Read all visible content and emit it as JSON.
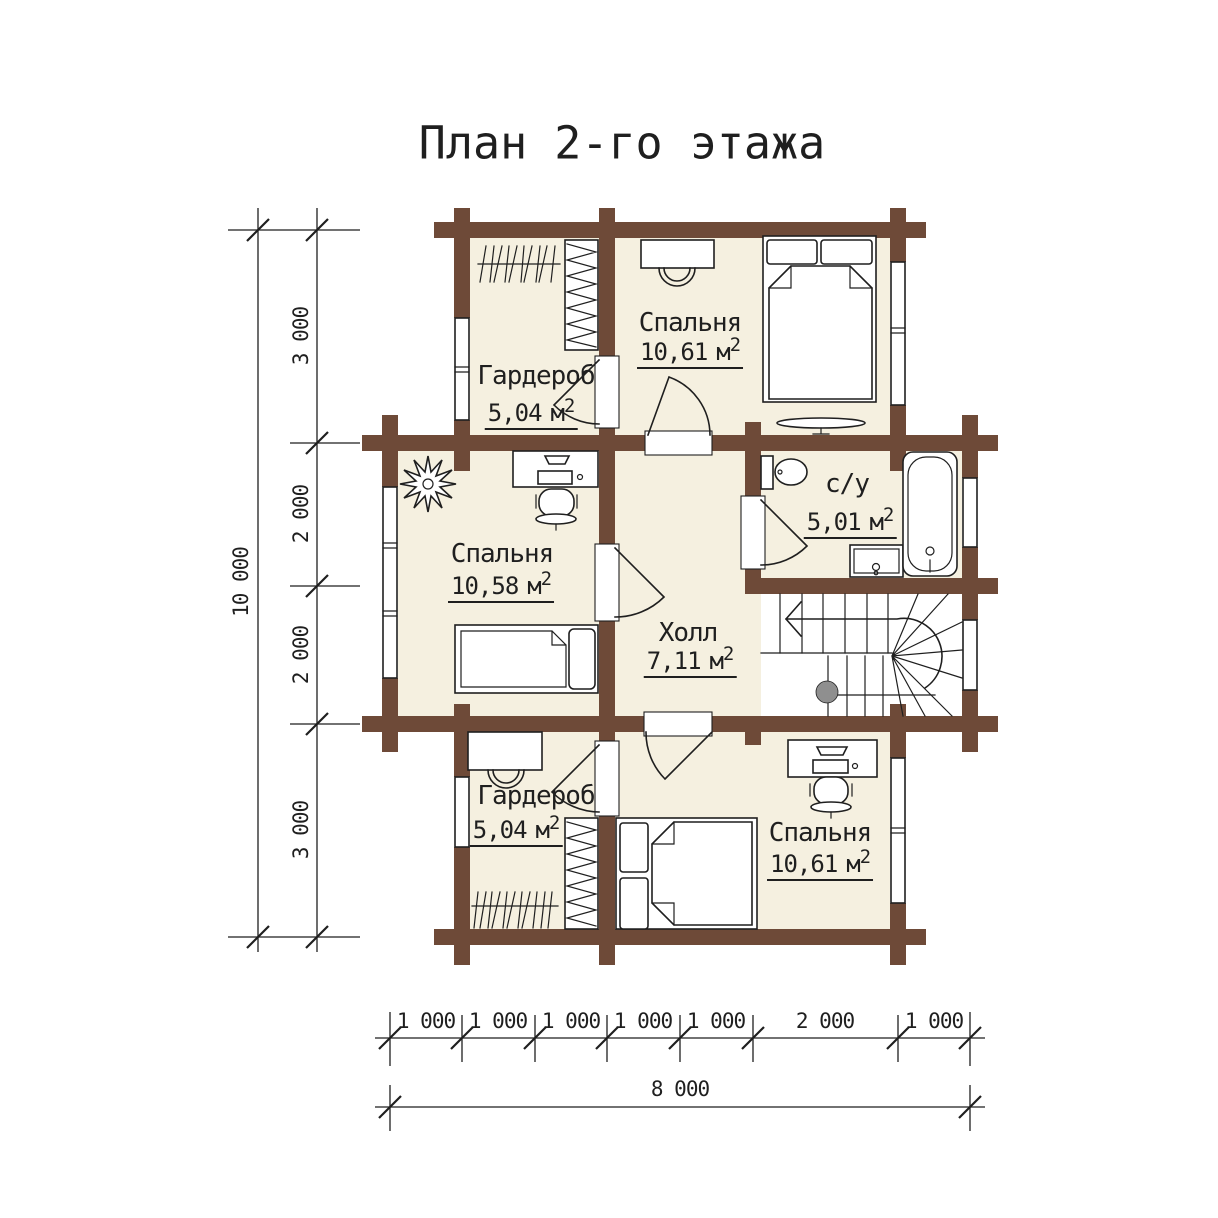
{
  "title": "План 2-го этажа",
  "units": {
    "area_unit": "м",
    "sup": "2"
  },
  "rooms": [
    {
      "id": "bedroom-top",
      "name": "Спальня",
      "area": "10,61"
    },
    {
      "id": "wardrobe-top",
      "name": "Гардероб",
      "area": "5,04"
    },
    {
      "id": "bedroom-left",
      "name": "Спальня",
      "area": "10,58"
    },
    {
      "id": "hall",
      "name": "Холл",
      "area": "7,11"
    },
    {
      "id": "bathroom",
      "name": "с/у",
      "area": "5,01"
    },
    {
      "id": "wardrobe-bottom",
      "name": "Гардероб",
      "area": "5,04"
    },
    {
      "id": "bedroom-bottom",
      "name": "Спальня",
      "area": "10,61"
    }
  ],
  "dimensions": {
    "vertical": {
      "segments": [
        "3 000",
        "2 000",
        "2 000",
        "3 000"
      ],
      "total": "10 000"
    },
    "horizontal": {
      "segments": [
        "1 000",
        "1 000",
        "1 000",
        "1 000",
        "1 000",
        "2 000",
        "1 000"
      ],
      "total": "8 000"
    }
  },
  "colors": {
    "wall": "#6e4a38",
    "floor": "#f5f0e0",
    "line": "#1f1f1f",
    "stair_post": "#8f8f8f"
  }
}
